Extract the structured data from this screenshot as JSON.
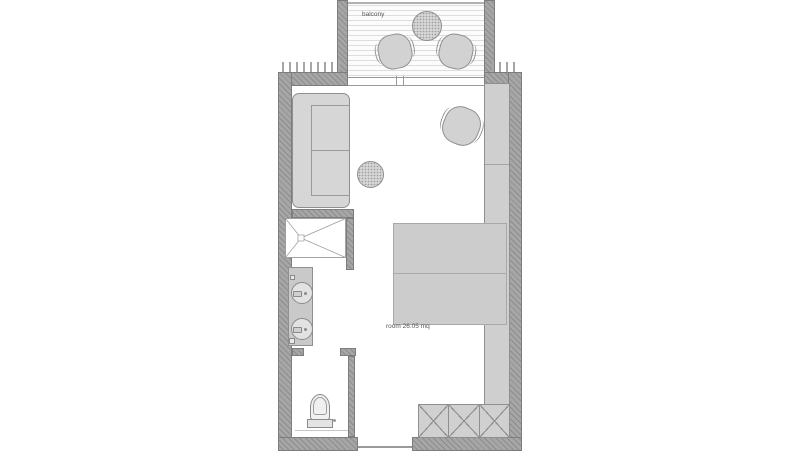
{
  "labels": {
    "balcony": "balcony",
    "room_area": "room 26.05 mq"
  },
  "colors": {
    "wall": "#a6a6a6",
    "wall_hatch": "#8f8f8f",
    "wall_edge": "#7d7d7d",
    "furn_fill": "#d4d4d4",
    "furn_border": "#8f8f8f",
    "bed_fill": "#cccccc",
    "deck_line": "#dddddd",
    "label_text": "#555555",
    "background": "#ffffff"
  },
  "furniture": [
    "balcony-table",
    "balcony-chair",
    "balcony-chair",
    "sofa",
    "coffee-table",
    "armchair",
    "wardrobe",
    "double-bed",
    "crossed-closet",
    "shower-tray",
    "vanity-counter",
    "sink",
    "sink",
    "toilet"
  ]
}
